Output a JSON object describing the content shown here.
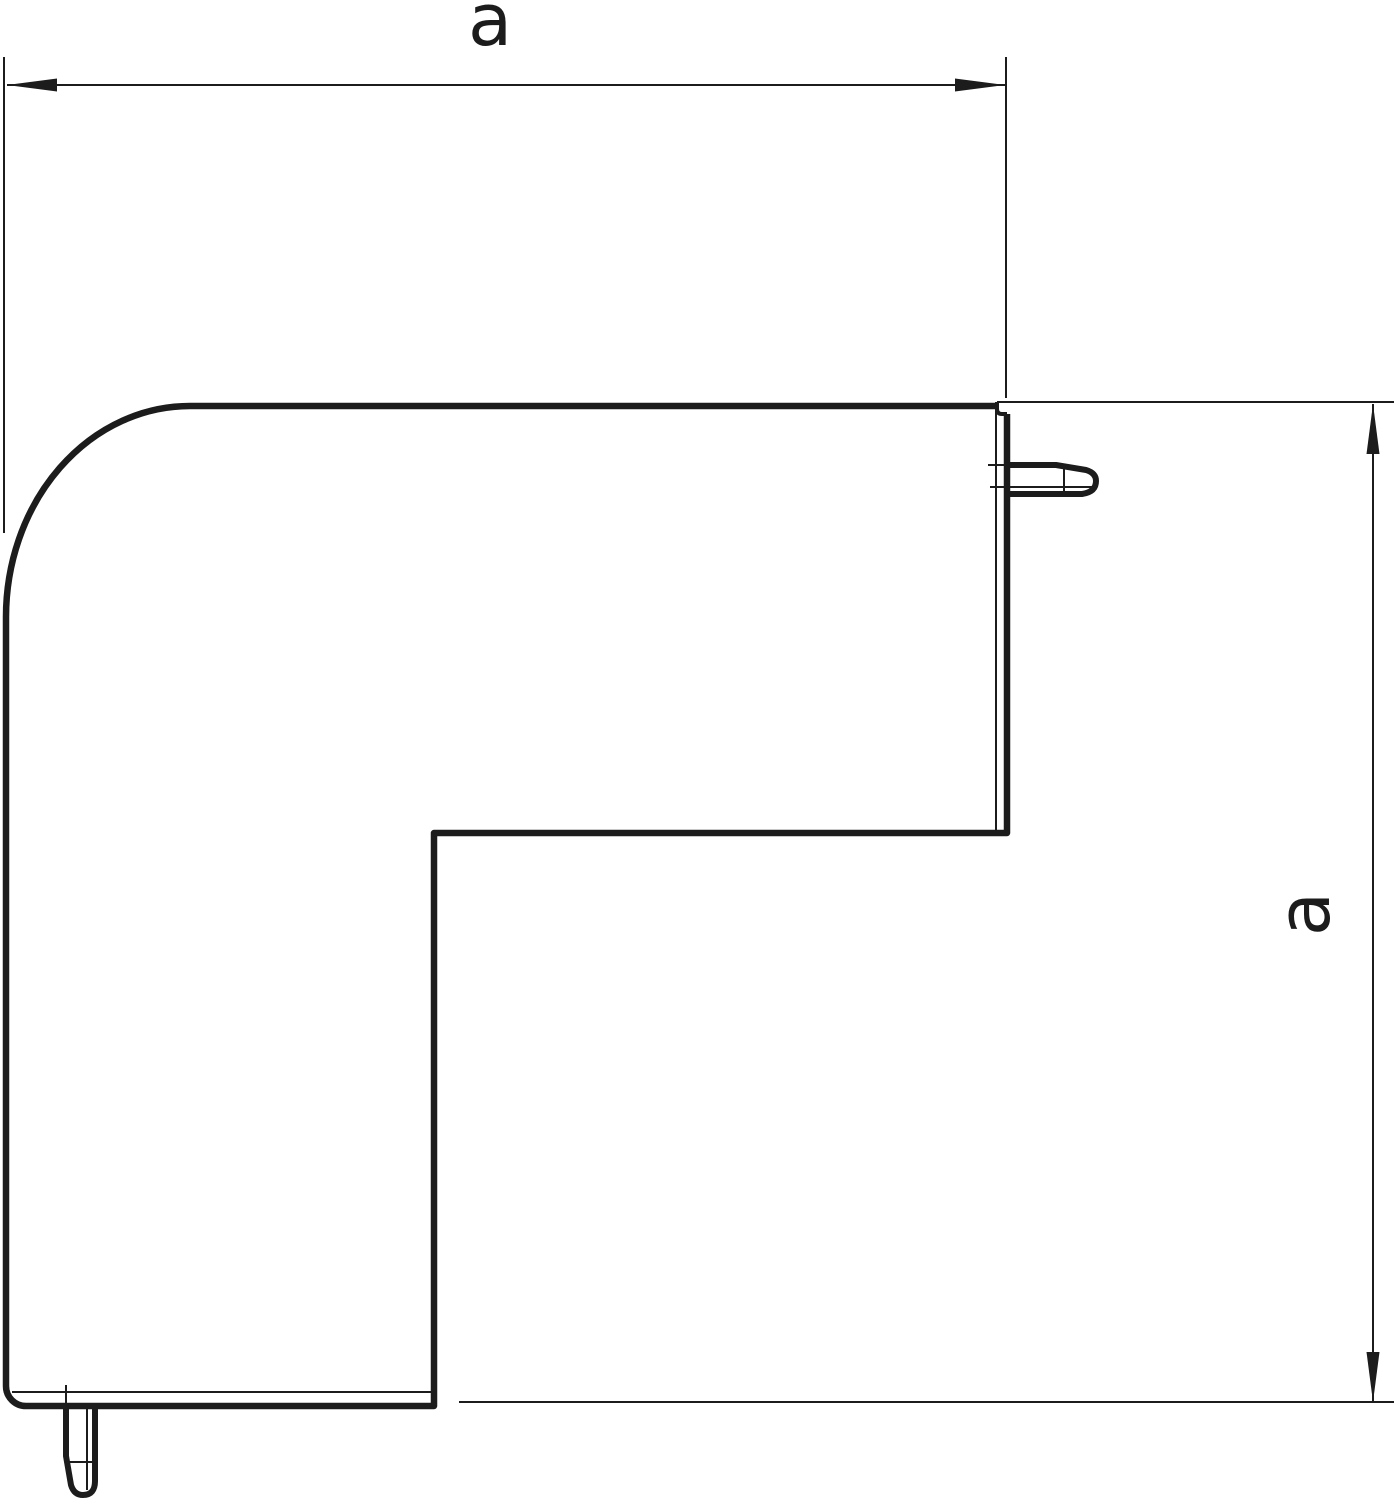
{
  "drawing": {
    "type": "technical-dimension-drawing",
    "subject": "flat-angle-outer-corner-piece",
    "background_color": "#ffffff",
    "line_color": "#1c1c1c",
    "horizontal_dimension_label": "a",
    "vertical_dimension_label": "a"
  }
}
